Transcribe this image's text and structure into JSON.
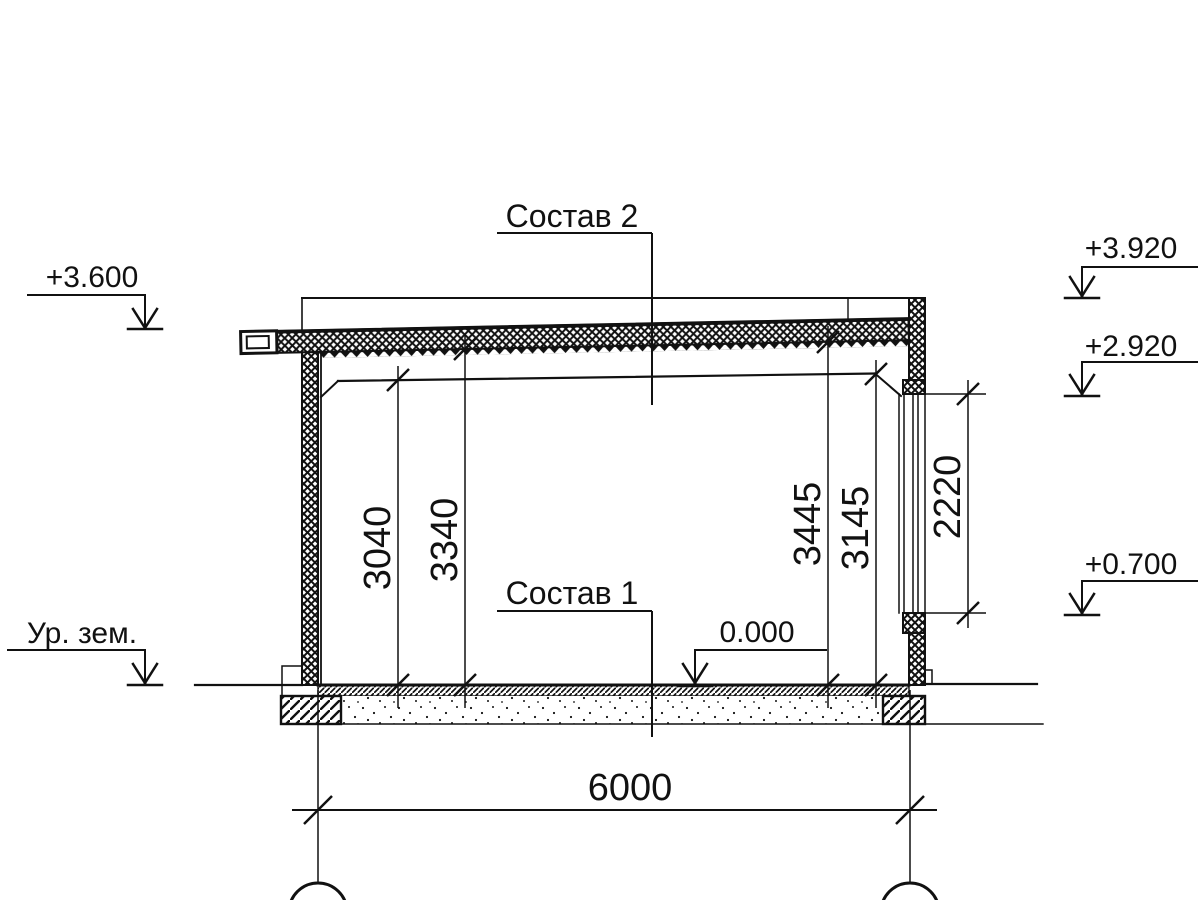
{
  "drawing": {
    "composition_labels": {
      "roof_composition": "Состав 2",
      "floor_composition": "Состав 1"
    },
    "elevation_marks": {
      "roof_eave_left": "+3.600",
      "ground_level_label": "Ур. зем.",
      "parapet_top_right": "+3.920",
      "beam_bottom_right": "+2.920",
      "opening_bottom_right": "+0.700",
      "floor_level": "0.000"
    },
    "vertical_dimensions": {
      "floor_to_beam_left": "3040",
      "floor_to_deck_left": "3340",
      "floor_to_deck_right": "3445",
      "floor_to_beam_right": "3145",
      "opening_height": "2220"
    },
    "horizontal_dimensions": {
      "span": "6000"
    },
    "colors": {
      "ink": "#111111",
      "paper": "#ffffff"
    }
  }
}
